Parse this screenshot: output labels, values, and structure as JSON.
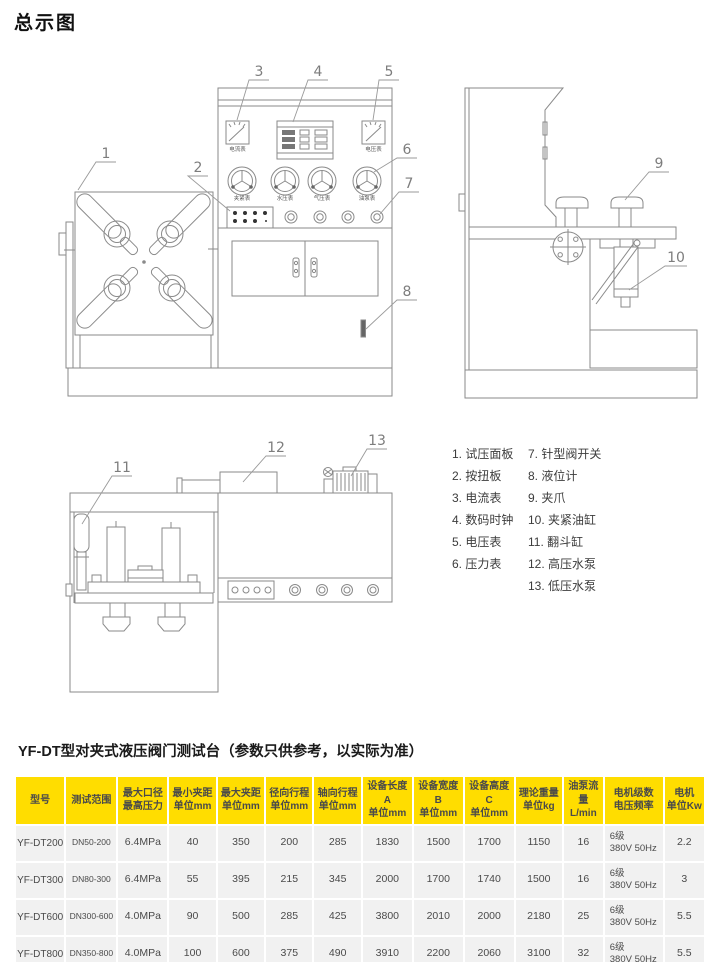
{
  "page": {
    "title": "总示图"
  },
  "diagram": {
    "callout_numbers": [
      "1",
      "2",
      "3",
      "4",
      "5",
      "6",
      "7",
      "8",
      "9",
      "10",
      "11",
      "12",
      "13"
    ],
    "meter_labels": {
      "ammeter": "电流表",
      "voltmeter": "电压表"
    },
    "gauge_labels": [
      "夹紧表",
      "水压表",
      "气压表",
      "油泵表"
    ]
  },
  "legend": {
    "items": [
      "1. 试压面板",
      "2. 按扭板",
      "3. 电流表",
      "4. 数码时钟",
      "5. 电压表",
      "6. 压力表",
      "7. 针型阀开关",
      "8. 液位计",
      "9. 夹爪",
      "10. 夹紧油缸",
      "11. 翻斗缸",
      "12. 高压水泵",
      "13. 低压水泵"
    ]
  },
  "table": {
    "title": "YF-DT型对夹式液压阀门测试台（参数只供参考，以实际为准）",
    "columns": [
      {
        "l1": "型号",
        "l2": ""
      },
      {
        "l1": "测试范围",
        "l2": ""
      },
      {
        "l1": "最大口径",
        "l2": "最高压力"
      },
      {
        "l1": "最小夹距",
        "l2": "单位mm"
      },
      {
        "l1": "最大夹距",
        "l2": "单位mm"
      },
      {
        "l1": "径向行程",
        "l2": "单位mm"
      },
      {
        "l1": "轴向行程",
        "l2": "单位mm"
      },
      {
        "l1": "设备长度A",
        "l2": "单位mm"
      },
      {
        "l1": "设备宽度B",
        "l2": "单位mm"
      },
      {
        "l1": "设备高度C",
        "l2": "单位mm"
      },
      {
        "l1": "理论重量",
        "l2": "单位kg"
      },
      {
        "l1": "油泵流量",
        "l2": "L/min"
      },
      {
        "l1": "电机级数",
        "l2": "电压频率"
      },
      {
        "l1": "电机",
        "l2": "单位Kw"
      }
    ],
    "rows": [
      [
        "YF-DT200",
        "DN50-200",
        "6.4MPa",
        "40",
        "350",
        "200",
        "285",
        "1830",
        "1500",
        "1700",
        "1150",
        "16",
        "6级\n380V 50Hz",
        "2.2"
      ],
      [
        "YF-DT300",
        "DN80-300",
        "6.4MPa",
        "55",
        "395",
        "215",
        "345",
        "2000",
        "1700",
        "1740",
        "1500",
        "16",
        "6级\n380V 50Hz",
        "3"
      ],
      [
        "YF-DT600",
        "DN300-600",
        "4.0MPa",
        "90",
        "500",
        "285",
        "425",
        "3800",
        "2010",
        "2000",
        "2180",
        "25",
        "6级\n380V 50Hz",
        "5.5"
      ],
      [
        "YF-DT800",
        "DN350-800",
        "4.0MPa",
        "100",
        "600",
        "375",
        "490",
        "3910",
        "2200",
        "2060",
        "3100",
        "32",
        "6级\n380V 50Hz",
        "5.5"
      ]
    ],
    "colors": {
      "header_bg": "#ffdd00",
      "row_bg": "#f1f1f1",
      "header_text": "#4a4a4a",
      "body_text": "#4a4a4a"
    }
  }
}
